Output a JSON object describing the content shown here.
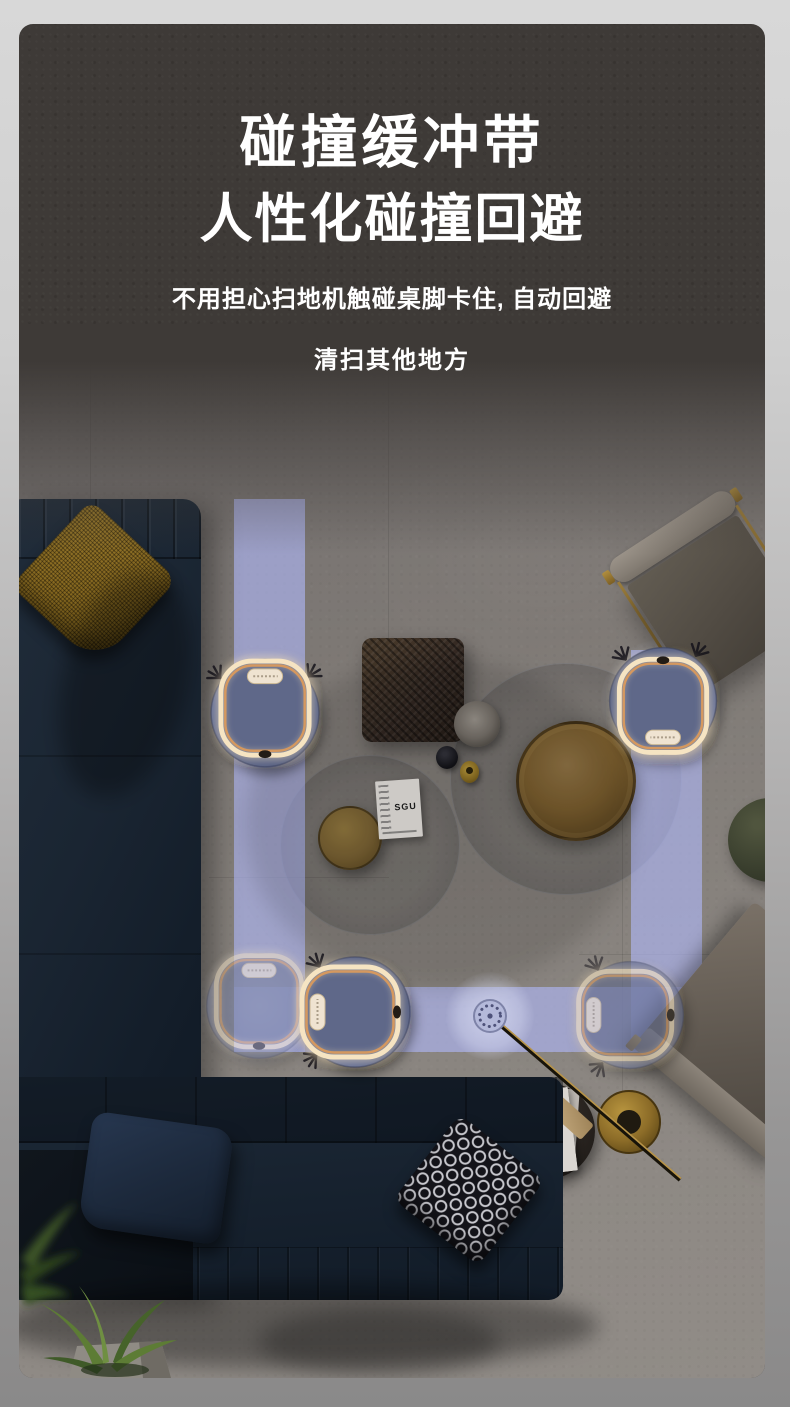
{
  "banner": {
    "title_line1": "碰撞缓冲带",
    "title_line2": "人性化碰撞回避",
    "subtitle_line1": "不用担心扫地机触碰桌脚卡住, 自动回避",
    "subtitle_line2": "清扫其他地方"
  },
  "scene": {
    "magazine_label": "SGU",
    "objects": [
      "robot-vacuum-top-left",
      "robot-vacuum-top-right",
      "robot-vacuum-bottom-ghost",
      "robot-vacuum-bottom-center",
      "robot-vacuum-bottom-right",
      "cleaning-path",
      "sofa",
      "coffee-tables",
      "armchair",
      "floor-lamp",
      "plants"
    ]
  },
  "colors": {
    "page_background_top": "#d8d8d8",
    "page_background_bottom": "#8a8989",
    "card_background": "#3e3a37",
    "title_text": "#ffffff",
    "path_accent": "#aab1dc",
    "robot_body": "#6a7498",
    "robot_glow_ring": "#f6e4c2",
    "sofa_navy": "#18222e"
  }
}
